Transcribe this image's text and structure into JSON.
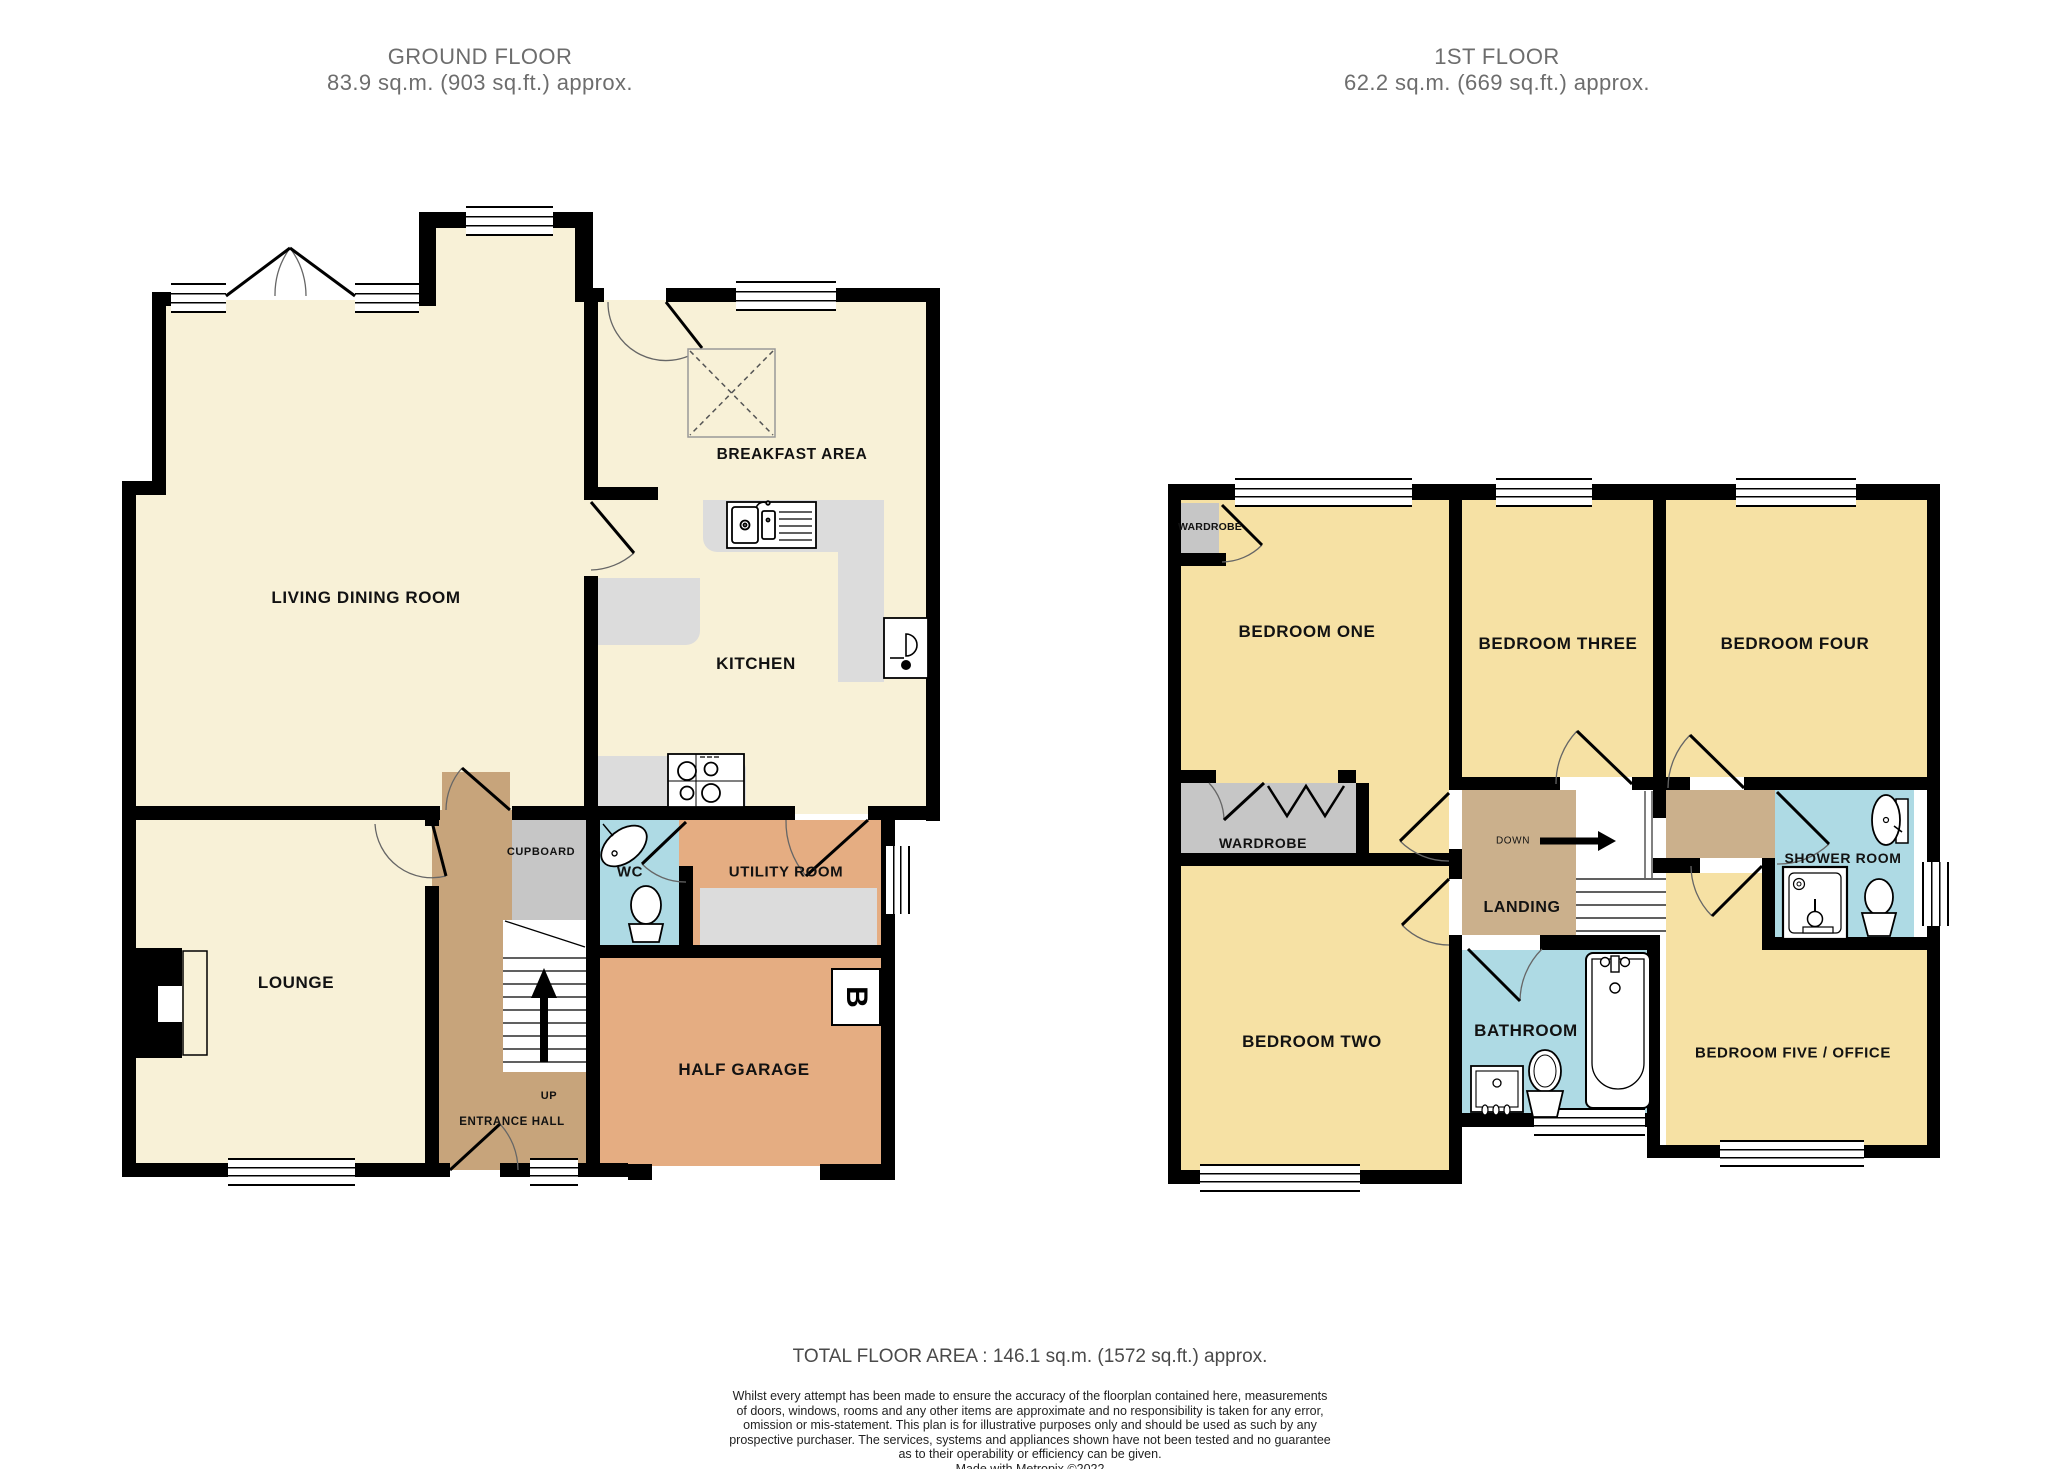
{
  "page": {
    "background": "#ffffff"
  },
  "ground_floor": {
    "title": "GROUND FLOOR",
    "subtitle": "83.9 sq.m. (903 sq.ft.) approx.",
    "labels": {
      "living": "LIVING DINING ROOM",
      "breakfast": "BREAKFAST AREA",
      "kitchen": "KITCHEN",
      "lounge": "LOUNGE",
      "cupboard": "CUPBOARD",
      "wc": "WC",
      "utility": "UTILITY ROOM",
      "entrance": "ENTRANCE HALL",
      "up": "UP",
      "garage": "HALF GARAGE",
      "boiler": "B"
    }
  },
  "first_floor": {
    "title": "1ST FLOOR",
    "subtitle": "62.2 sq.m. (669 sq.ft.) approx.",
    "labels": {
      "bedroom_one": "BEDROOM ONE",
      "bedroom_two": "BEDROOM TWO",
      "bedroom_three": "BEDROOM THREE",
      "bedroom_four": "BEDROOM FOUR",
      "bedroom_five": "BEDROOM FIVE / OFFICE",
      "wardrobe_small": "WARDROBE",
      "wardrobe": "WARDROBE",
      "landing": "LANDING",
      "down": "DOWN",
      "bathroom": "BATHROOM",
      "shower": "SHOWER ROOM"
    }
  },
  "footer": {
    "total_area": "TOTAL FLOOR AREA : 146.1 sq.m. (1572 sq.ft.) approx.",
    "disclaimer_lines": [
      "Whilst every attempt has been made to ensure the accuracy of the floorplan contained here, measurements",
      "of doors, windows, rooms and any other items are approximate and no responsibility is taken for any error,",
      "omission or mis-statement. This plan is for illustrative purposes only and should be used as such by any",
      "prospective purchaser. The services, systems and appliances shown have not been tested and no guarantee",
      "as to their operability or efficiency can be given."
    ],
    "credit": "Made with Metropix ©2022"
  },
  "colors": {
    "ground_room": "#f8f1d7",
    "bedroom": "#f6e1a4",
    "hall": "#c7a47b",
    "landing": "#cbb08c",
    "garage": "#e5ad82",
    "wet_room": "#aedae4",
    "counter": "#dcdcdc",
    "wardrobe": "#c6c6c6",
    "wall": "#000000"
  }
}
